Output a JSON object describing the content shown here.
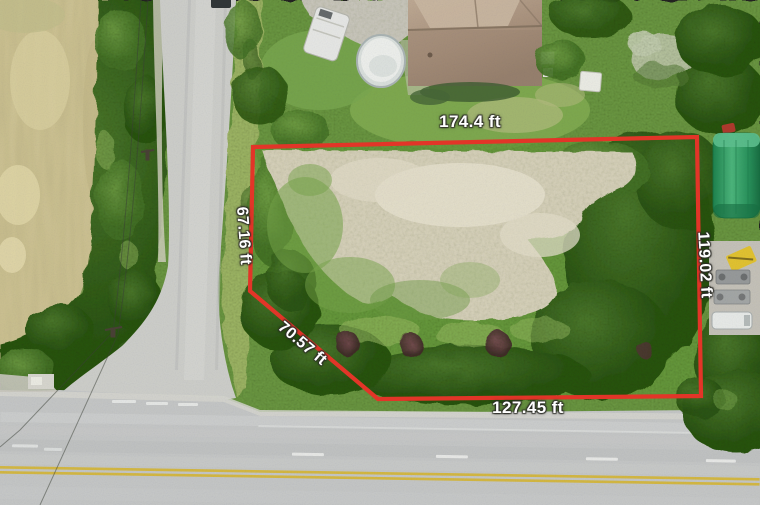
{
  "boundary": {
    "color": "#e23528",
    "stroke_width": 4.2,
    "polygon_points": "253,147 697,137 701,396 378,399 250,291",
    "labels": {
      "top": {
        "text": "174.4 ft",
        "x": 470,
        "y": 122,
        "rotation": 0
      },
      "left": {
        "text": "67.16 ft",
        "x": 243,
        "y": 236,
        "rotation": 86
      },
      "diagonal": {
        "text": "70.57 ft",
        "x": 302,
        "y": 344,
        "rotation": 40
      },
      "bottom": {
        "text": "127.45 ft",
        "x": 528,
        "y": 408,
        "rotation": 0
      },
      "right": {
        "text": "119.02 ft",
        "x": 704,
        "y": 265,
        "rotation": 87
      }
    }
  },
  "scene": {
    "objects": [
      "farm-field",
      "tree-line",
      "country-road",
      "highway",
      "house-roof",
      "swimming-pool",
      "rv-trailer",
      "shed",
      "green-storage-tank",
      "equipment-pad",
      "utility-van",
      "sand-clearing",
      "power-lines",
      "purple-shrubs",
      "overhanging-tree",
      "parked-car"
    ],
    "palette": {
      "grass": "#6f9e47",
      "dark_trees": "#2c5619",
      "light_brush": "#9cc266",
      "field": "#d7cc9e",
      "sand": "#ded8c3",
      "road": "#c9cbcd",
      "yellow_line": "#d9bc45",
      "white_line": "#f4f6f6",
      "house_roof": "#ab9380",
      "pool": "#f3f5f4",
      "tank_green": "#2f9e68",
      "equipment_yellow": "#e7c733"
    }
  }
}
